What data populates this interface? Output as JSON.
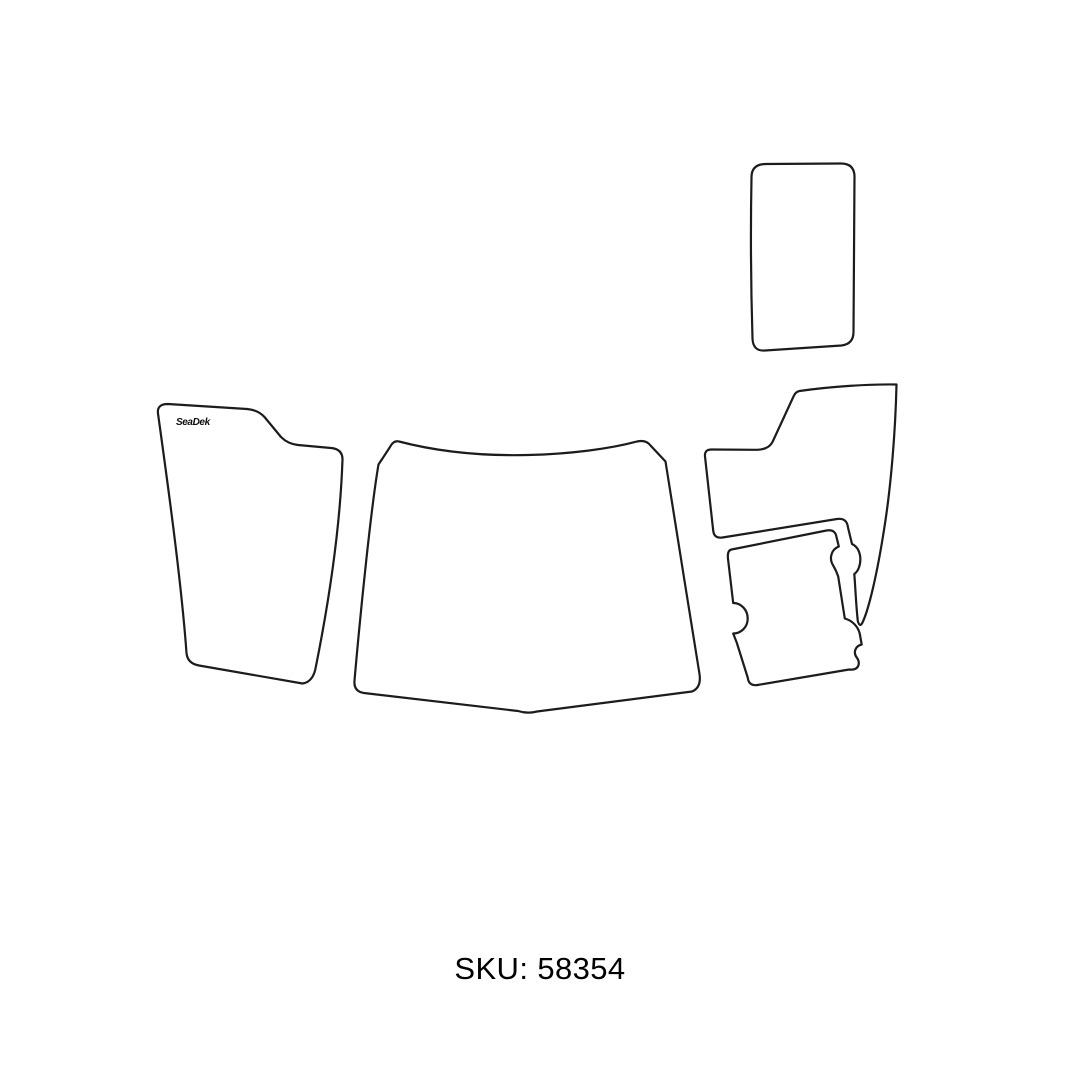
{
  "page": {
    "background": "#ffffff"
  },
  "colors": {
    "outline": "#1c1c1c",
    "fill": "#ffffff",
    "text": "#010101"
  },
  "diagram": {
    "brand_label": "SeaDek",
    "sku_label": "SKU: 58354",
    "pieces": [
      {
        "name": "step-pad-piece"
      },
      {
        "name": "port-side-pad-piece"
      },
      {
        "name": "center-pad-piece"
      },
      {
        "name": "starboard-upper-pad-piece"
      },
      {
        "name": "starboard-lower-pad-piece"
      }
    ]
  }
}
